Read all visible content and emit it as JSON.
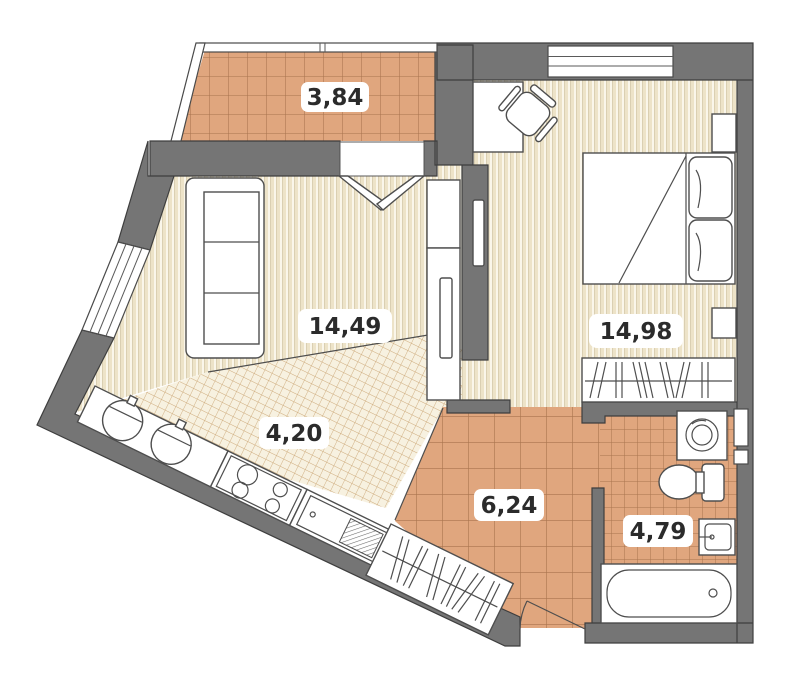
{
  "plan": {
    "type": "apartment-floor-plan",
    "rooms": [
      {
        "name": "balcony",
        "area_m2": "3,84"
      },
      {
        "name": "living-room",
        "area_m2": "14,49"
      },
      {
        "name": "bedroom",
        "area_m2": "14,98"
      },
      {
        "name": "kitchen",
        "area_m2": "4,20"
      },
      {
        "name": "hallway",
        "area_m2": "6,24"
      },
      {
        "name": "bathroom",
        "area_m2": "4,79"
      }
    ]
  },
  "colors": {
    "wall": "#757575",
    "outline": "#3E3E3E",
    "tile": "#E0A67E",
    "tile_line": "#A9744E",
    "floor_base": "#FAF6EA",
    "floor_stripe": "#EDE3C8",
    "hatch_line": "#CDAA7B",
    "furniture_stroke": "#4E4E4E",
    "label_text": "#2B2B2B"
  }
}
